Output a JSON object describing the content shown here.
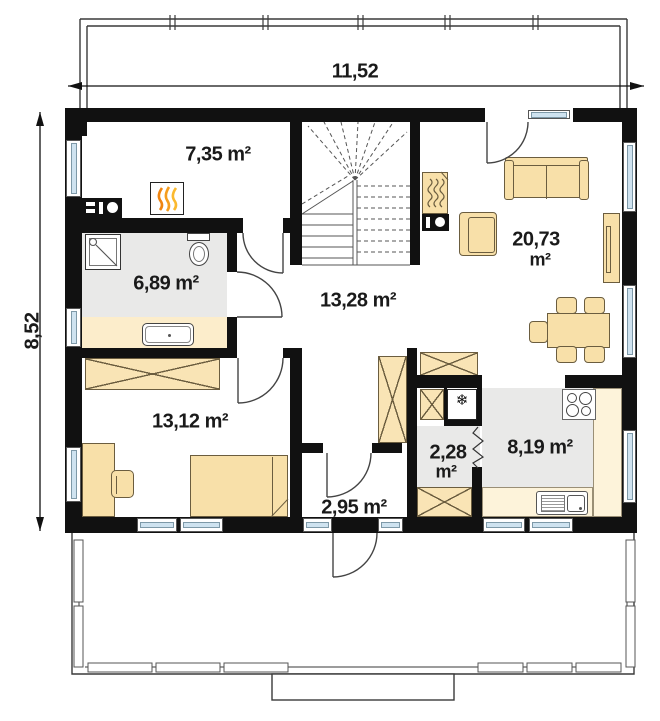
{
  "plan": {
    "type": "floor-plan",
    "dimensions": {
      "width": "11,52",
      "height": "8,52"
    },
    "rooms": {
      "utility": {
        "area": "7,35 m²"
      },
      "bathroom": {
        "area": "6,89 m²"
      },
      "hall": {
        "area": "13,28 m²"
      },
      "living": {
        "area_value": "20,73",
        "area_unit": "m²"
      },
      "bedroom": {
        "area": "13,12 m²"
      },
      "vestibule": {
        "area": "2,95 m²"
      },
      "pantry": {
        "area_value": "2,28",
        "area_unit": "m²"
      },
      "kitchen": {
        "area": "8,19 m²"
      }
    },
    "icons": {
      "fridge_snowflake": "❄"
    },
    "colors": {
      "wall": "#111111",
      "floor_gray": "#e9e9e8",
      "furniture_beige": "#f8e0a9",
      "counter_cream": "#fdf3da",
      "window_glass": "#cfe3f0",
      "flame_orange": "#f59d1e"
    }
  }
}
